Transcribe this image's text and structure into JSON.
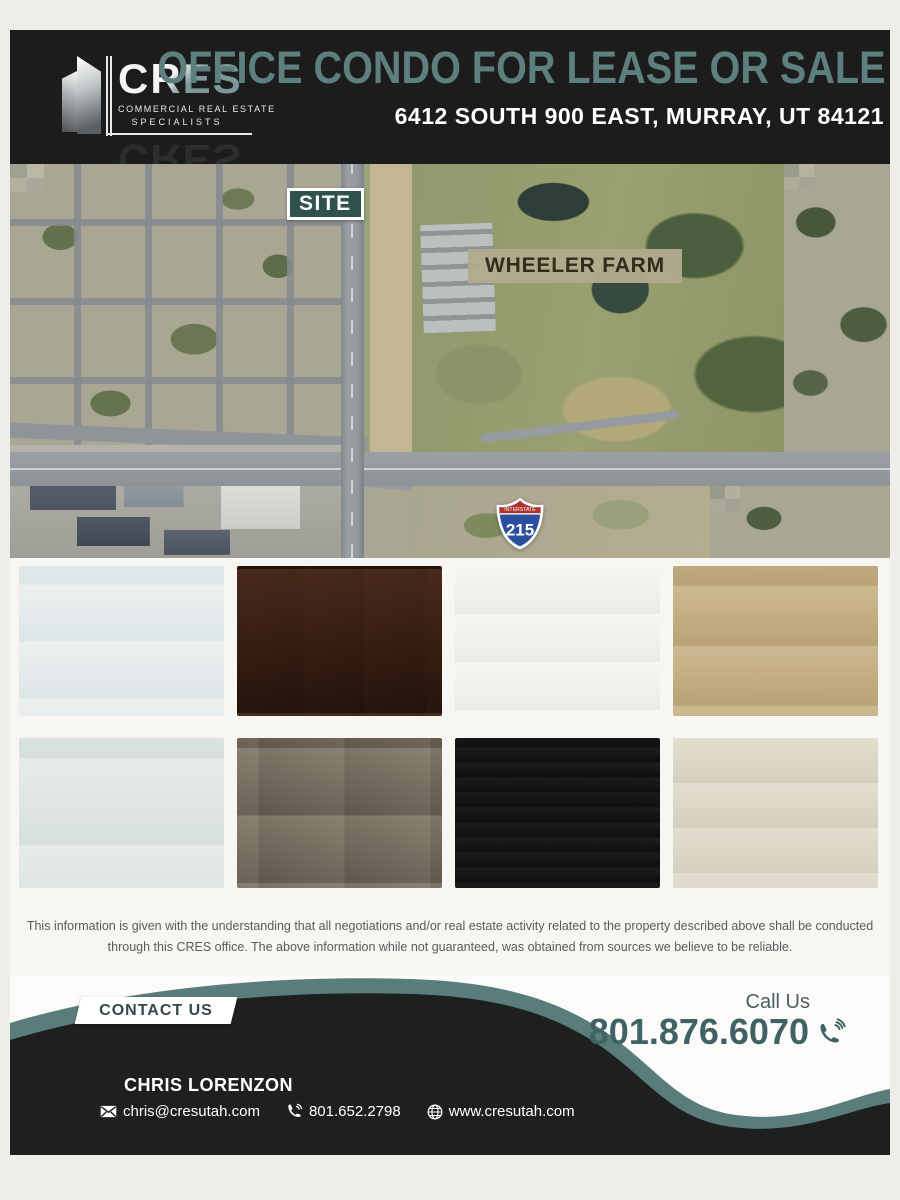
{
  "header": {
    "brand": "CRES",
    "brand_sub1": "COMMERCIAL REAL ESTATE",
    "brand_sub2": "SPECIALISTS",
    "title": "OFFICE CONDO FOR LEASE OR SALE",
    "address": "6412 SOUTH 900 EAST, MURRAY, UT 84121"
  },
  "map": {
    "site_label": "SITE",
    "park_label": "WHEELER FARM",
    "interstate_label": "INTERSTATE",
    "interstate_number": "215"
  },
  "disclaimer": {
    "line1": "This information is given with the understanding that all negotiations and/or real estate activity related to the property described above shall be conducted",
    "line2": "through this CRES office. The above information while not guaranteed, was obtained from sources we believe to be reliable."
  },
  "footer": {
    "contact_us": "CONTACT US",
    "call_us": "Call Us",
    "phone_main": "801.876.6070",
    "agent_name": "CHRIS LORENZON",
    "agent_email": "chris@cresutah.com",
    "agent_phone": "801.652.2798",
    "agent_website": "www.cresutah.com"
  },
  "colors": {
    "header_bg": "#1c1c1c",
    "title_teal": "#5d7f7e",
    "wave_teal": "#587d7a",
    "footer_dark": "#1e201f",
    "phone_teal": "#3f6265",
    "site_badge_bg": "#2f524b",
    "park_badge_bg": "#b2aa8c",
    "shield_red": "#b0312d",
    "shield_blue": "#2b4f9e"
  }
}
